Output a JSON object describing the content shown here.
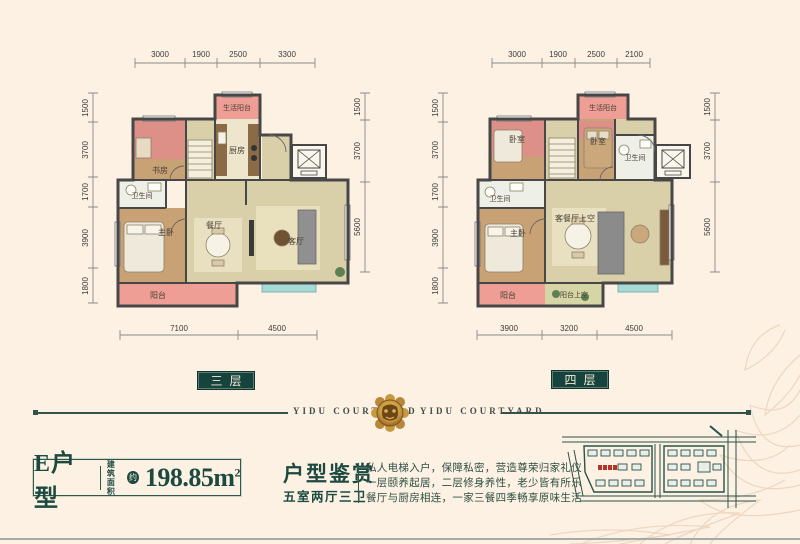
{
  "plans": [
    {
      "floor_label": "三层",
      "dims_top": [
        "3000",
        "1900",
        "2500",
        "3300"
      ],
      "dims_left": [
        "1500",
        "3700",
        "1700",
        "3900",
        "1800"
      ],
      "dims_right": [
        "1500",
        "3700",
        "5600"
      ],
      "dims_bottom": [
        "7100",
        "4500"
      ],
      "rooms": {
        "service_balcony": "生活阳台",
        "study": "书房",
        "kitchen": "厨房",
        "bath": "卫生间",
        "master": "主卧",
        "dining": "餐厅",
        "living": "客厅",
        "balcony": "阳台"
      }
    },
    {
      "floor_label": "四层",
      "dims_top": [
        "3000",
        "1900",
        "2500",
        "2100"
      ],
      "dims_left": [
        "1500",
        "3700",
        "1700",
        "3900",
        "1800"
      ],
      "dims_right": [
        "1500",
        "3700",
        "5600"
      ],
      "dims_bottom": [
        "3900",
        "3200",
        "4500"
      ],
      "rooms": {
        "service_balcony": "生活阳台",
        "bedroom1": "卧室",
        "bedroom2": "卧室",
        "bath_upper": "卫生间",
        "bath_lower": "卫生间",
        "master": "主卧",
        "living_void": "客餐厅上空",
        "balcony": "阳台",
        "balcony_void": "阳台上空"
      }
    }
  ],
  "brand": {
    "wordmark": "YIDU COURTYARD"
  },
  "unit_info": {
    "name": "E户型",
    "area_label_top": "建筑",
    "area_label_bottom": "面积",
    "approx": "约",
    "value": "198.85",
    "unit": "m",
    "exponent": "2"
  },
  "appreciation": {
    "title": "户型鉴赏",
    "subtitle": "五室两厅三卫",
    "lines": [
      "私人电梯入户，保障私密，营造尊荣归家礼仪",
      "一层颐养起居，二层修身养性，老少皆有所乐",
      "餐厅与厨房相连，一家三餐四季畅享原味生活"
    ]
  },
  "colors": {
    "background": "#fcf1e3",
    "teal": "#16443c",
    "wall": "#474747",
    "bedroom_pink": "#dc9088",
    "balcony_pink": "#ee9e94",
    "wood": "#c8a274",
    "khaki": "#d9cfa8",
    "highlight_red": "#b93226",
    "gold": "#c89a3f"
  }
}
